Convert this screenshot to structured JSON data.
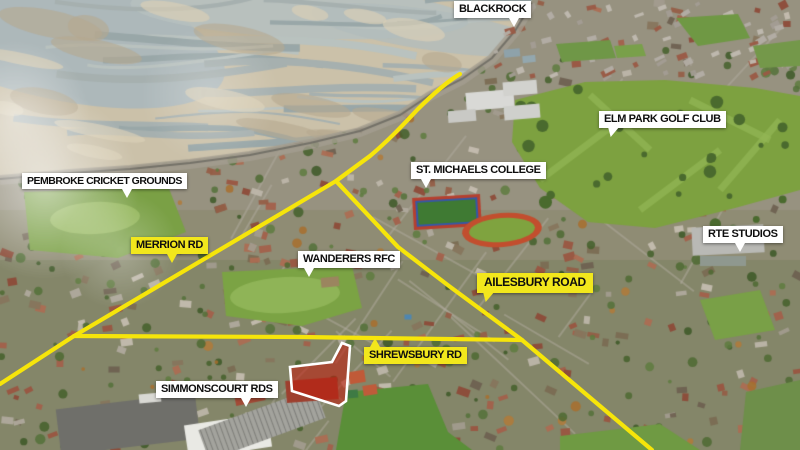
{
  "labels": {
    "blackrock": "BLACKROCK",
    "elm_park": "ELM PARK GOLF CLUB",
    "pembroke": "PEMBROKE CRICKET GROUNDS",
    "st_michaels": "ST. MICHAELS COLLEGE",
    "merrion": "MERRION RD",
    "wanderers": "WANDERERS RFC",
    "ailesbury": "AILESBURY ROAD",
    "rte": "RTE STUDIOS",
    "shrewsbury": "SHREWSBURY RD",
    "simmonscourt": "SIMMONSCOURT RDS"
  },
  "colors": {
    "road_line": "#f6e50a",
    "label_yellow": "#f2e71c",
    "label_white": "#ffffff",
    "label_text": "#0e0e0e",
    "site_fill": "#bf1d0e",
    "site_outline": "#ffffff"
  }
}
